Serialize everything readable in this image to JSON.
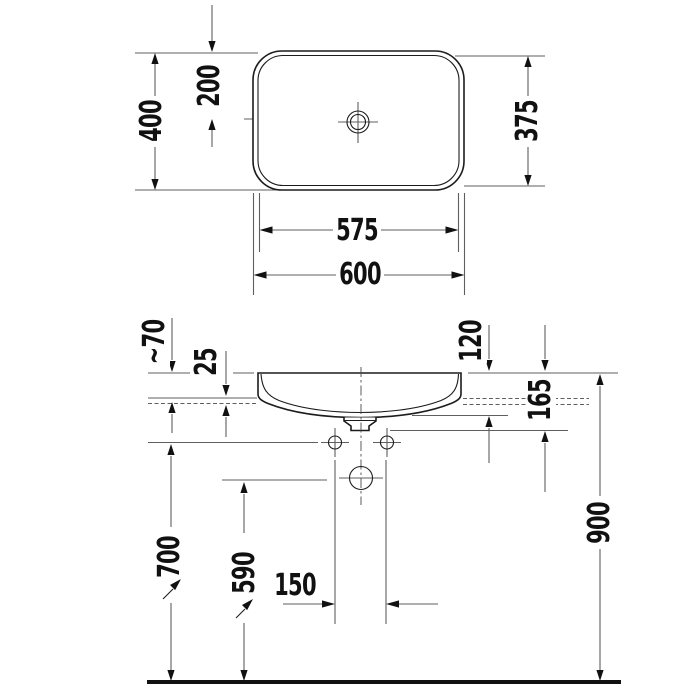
{
  "colors": {
    "background": "#ffffff",
    "object_line": "#1c1c1c",
    "dimension_line": "#5f5f5f",
    "text": "#111111"
  },
  "top_view": {
    "outer_width": "600",
    "inner_width": "575",
    "outer_depth": "400",
    "inner_depth": "375",
    "center_offset": "200"
  },
  "side_view": {
    "above_counter": "~70",
    "rim_offset": "25",
    "recess_depth": "120",
    "overall_height": "165",
    "fixing_height": "700",
    "drain_height": "590",
    "drain_spacing": "150",
    "rim_height": "900"
  }
}
